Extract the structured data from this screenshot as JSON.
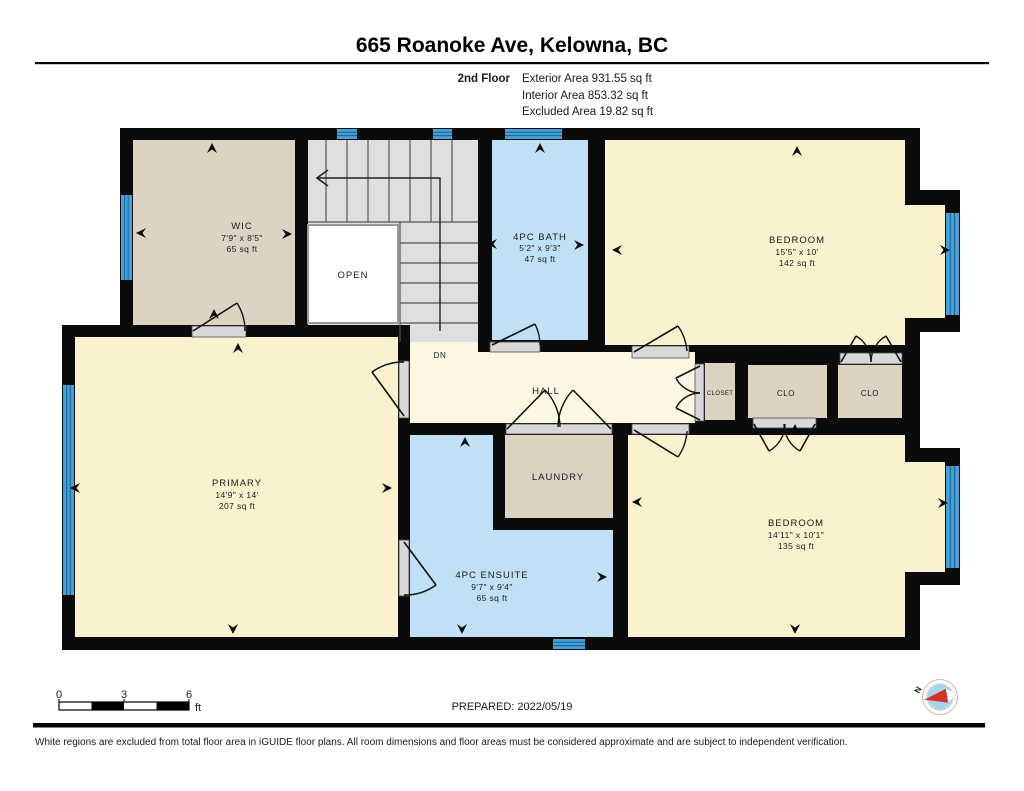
{
  "header": {
    "title": "665 Roanoke Ave, Kelowna, BC",
    "floor_label": "2nd Floor",
    "exterior_area": "Exterior Area 931.55 sq ft",
    "interior_area": "Interior Area 853.32 sq ft",
    "excluded_area": "Excluded Area 19.82 sq ft"
  },
  "rooms": {
    "wic": {
      "name": "WIC",
      "dims": "7'9\" x 8'5\"",
      "area": "65 sq ft"
    },
    "bath": {
      "name": "4PC BATH",
      "dims": "5'2\" x 9'3\"",
      "area": "47 sq ft"
    },
    "bedroom_top": {
      "name": "BEDROOM",
      "dims": "15'5\" x 10'",
      "area": "142 sq ft"
    },
    "primary": {
      "name": "PRIMARY",
      "dims": "14'9\" x 14'",
      "area": "207 sq ft"
    },
    "hall": {
      "name": "HALL"
    },
    "closet": {
      "name": "CLOSET"
    },
    "clo_left": {
      "name": "CLO"
    },
    "clo_right": {
      "name": "CLO"
    },
    "laundry": {
      "name": "LAUNDRY"
    },
    "ensuite": {
      "name": "4PC ENSUITE",
      "dims": "9'7\" x 9'4\"",
      "area": "65 sq ft"
    },
    "bedroom_bottom": {
      "name": "BEDROOM",
      "dims": "14'11\" x 10'1\"",
      "area": "135 sq ft"
    },
    "open_below": {
      "name": "OPEN"
    },
    "stairs_down": {
      "name": "DN"
    }
  },
  "scale_bar": {
    "ticks": [
      "0",
      "3",
      "6"
    ],
    "unit": "ft"
  },
  "compass": {
    "north_label": "N"
  },
  "footer": {
    "prepared": "PREPARED: 2022/05/19",
    "disclaimer": "White regions are excluded from total floor area in iGUIDE floor plans. All room dimensions and floor areas must be considered approximate and are subject to independent verification."
  },
  "colors": {
    "wall": "#0b0b0b",
    "room": "#FAF1CE",
    "hall": "#FCF7E3",
    "tan": "#DCD3C3",
    "blue": "#BFE0F5",
    "stairs": "#DFDFDF",
    "window": "#45A1D8",
    "compass_red": "#D93025"
  }
}
